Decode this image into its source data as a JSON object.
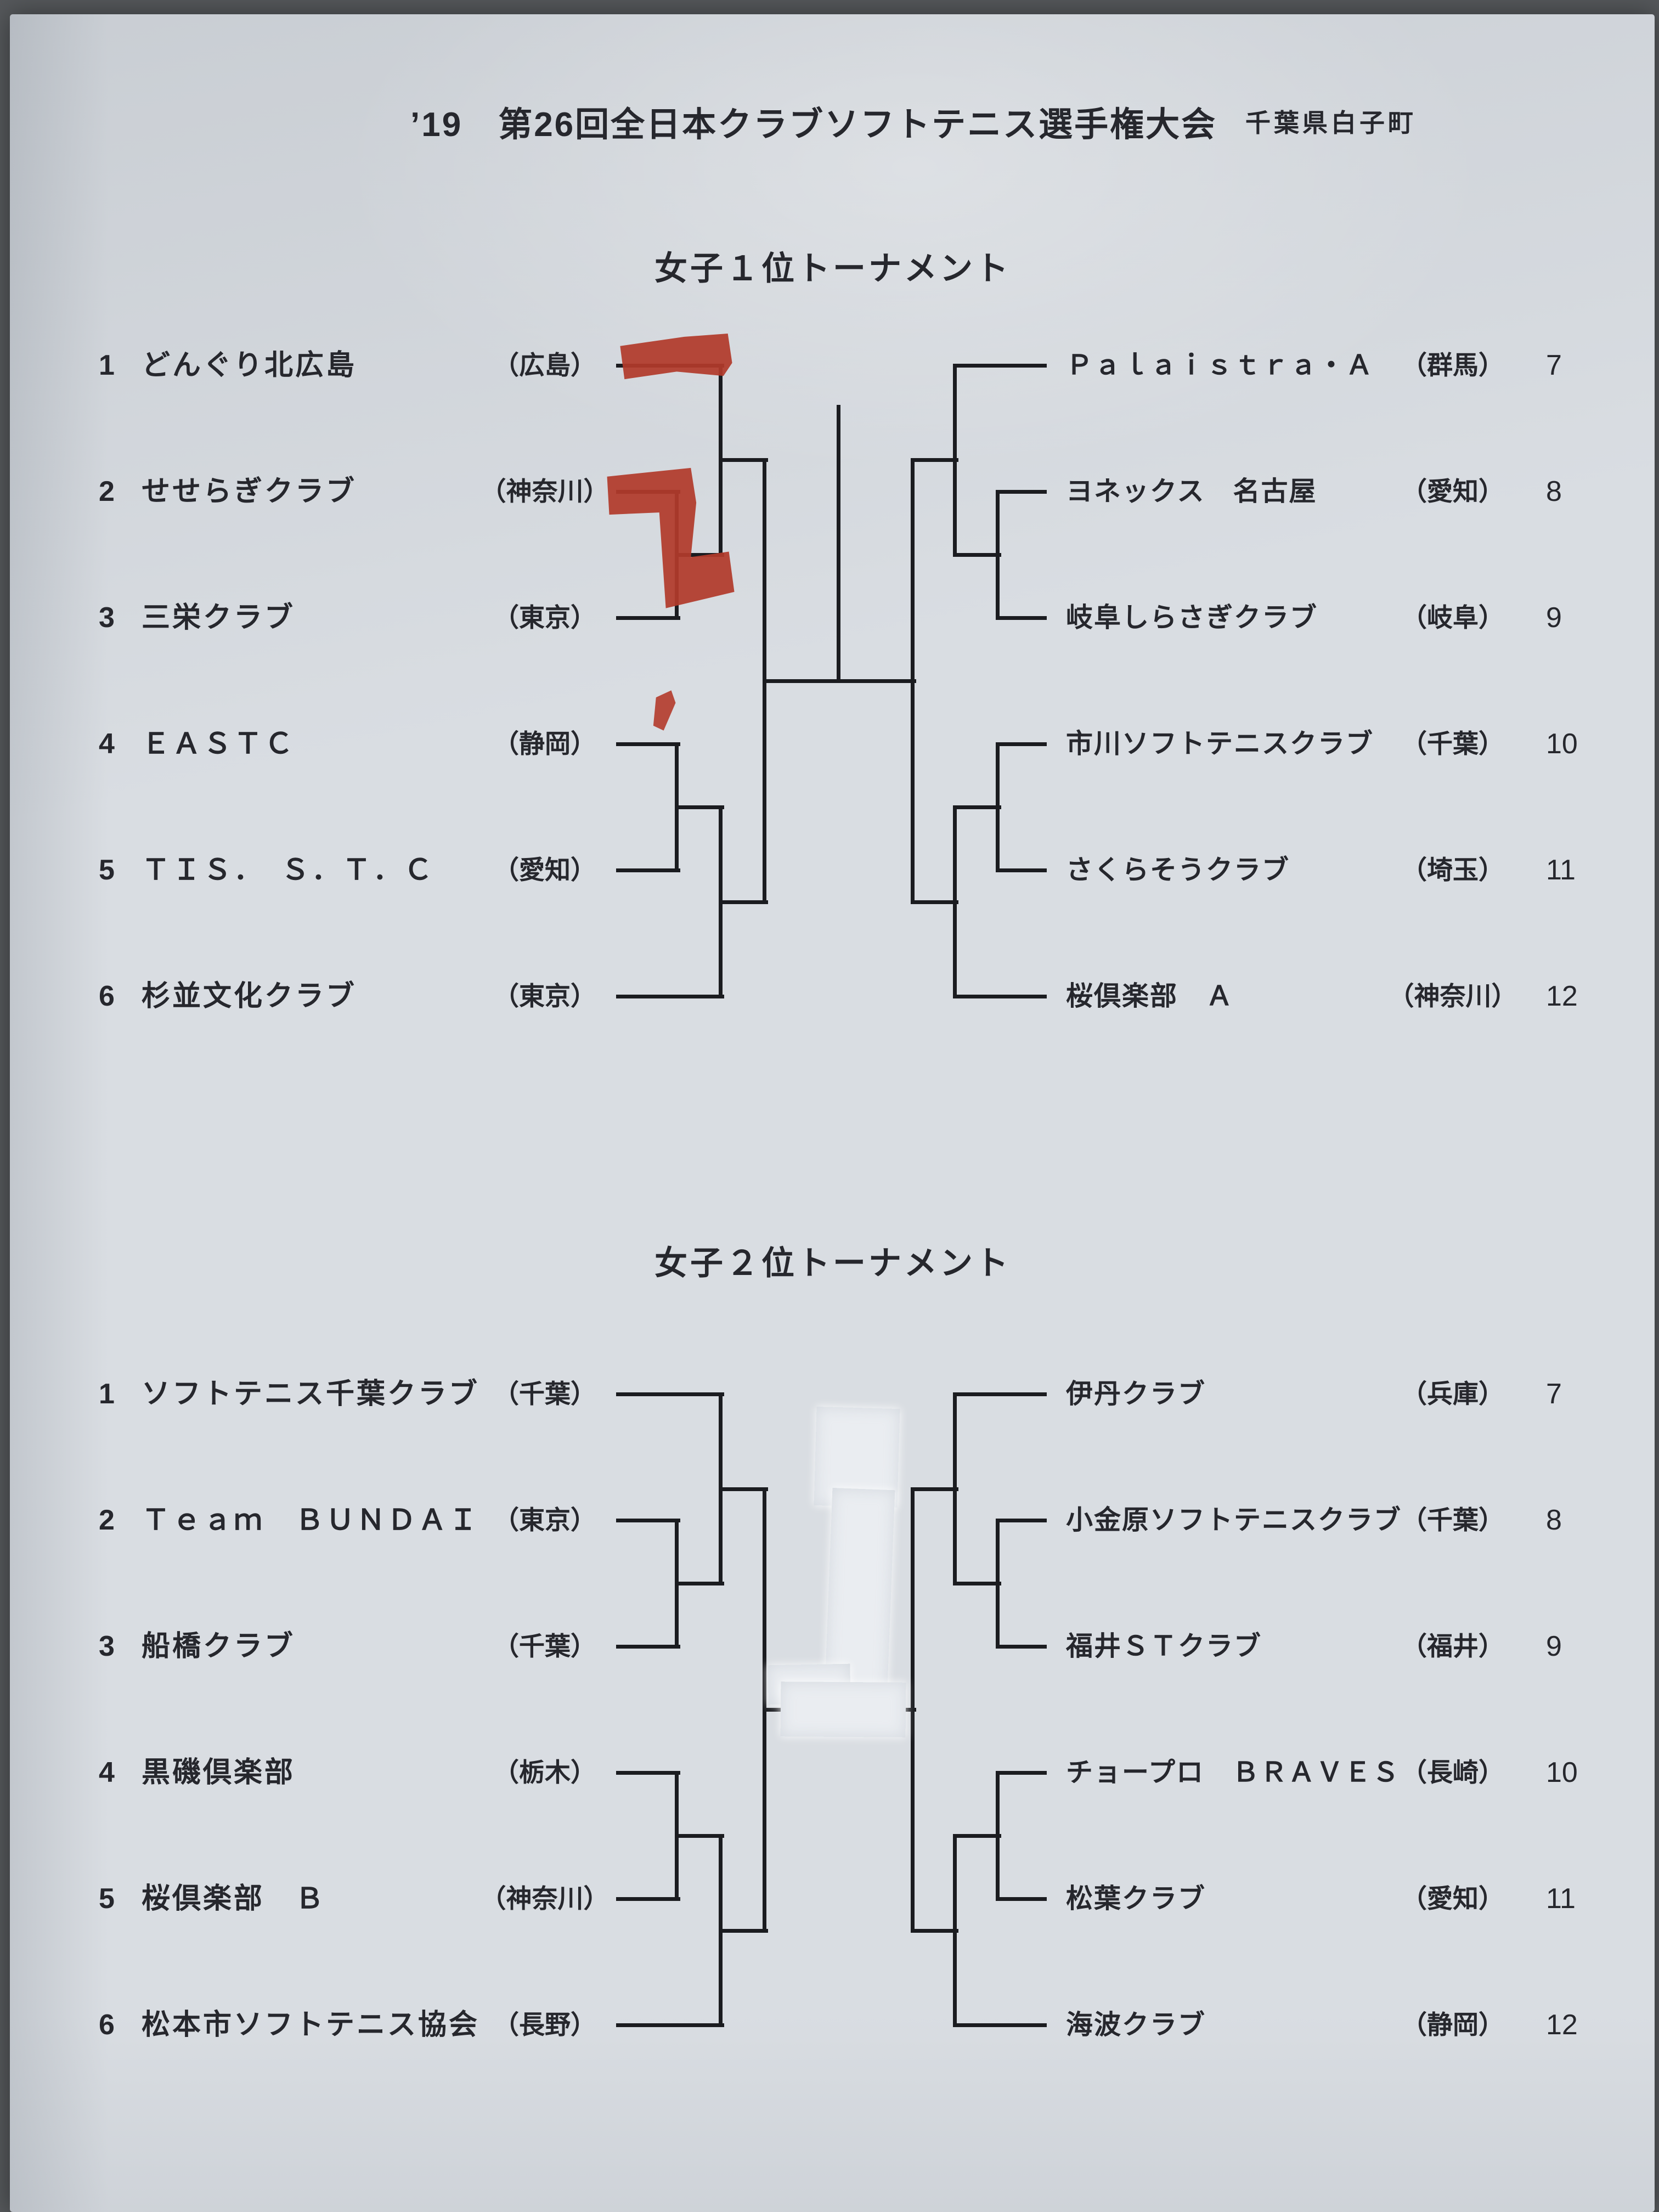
{
  "header": {
    "event_title": "’19　第26回全日本クラブソフトテニス選手権大会",
    "location": "千葉県白子町"
  },
  "colors": {
    "paper": "#d9dde2",
    "ink": "#26272d",
    "bracket_line": "#1b1c20",
    "red_marker": "#b23a2b",
    "correction_tape": "#eaedf1",
    "backdrop": "#55585b"
  },
  "tournaments": [
    {
      "title": "女子１位トーナメント",
      "left": [
        {
          "seed": "1",
          "name": "どんぐり北広島",
          "pref": "（広島）"
        },
        {
          "seed": "2",
          "name": "せせらぎクラブ",
          "pref": "（神奈川）"
        },
        {
          "seed": "3",
          "name": "三栄クラブ",
          "pref": "（東京）"
        },
        {
          "seed": "4",
          "name": "ＥＡＳＴＣ",
          "pref": "（静岡）"
        },
        {
          "seed": "5",
          "name": "ＴＩＳ．　Ｓ．Ｔ．Ｃ",
          "pref": "（愛知）"
        },
        {
          "seed": "6",
          "name": "杉並文化クラブ",
          "pref": "（東京）"
        }
      ],
      "right": [
        {
          "seed": "7",
          "name": "Ｐａｌａｉｓｔｒａ・Ａ",
          "pref": "（群馬）"
        },
        {
          "seed": "8",
          "name": "ヨネックス　名古屋",
          "pref": "（愛知）"
        },
        {
          "seed": "9",
          "name": "岐阜しらさぎクラブ",
          "pref": "（岐阜）"
        },
        {
          "seed": "10",
          "name": "市川ソフトテニスクラブ",
          "pref": "（千葉）"
        },
        {
          "seed": "11",
          "name": "さくらそうクラブ",
          "pref": "（埼玉）"
        },
        {
          "seed": "12",
          "name": "桜倶楽部　Ａ",
          "pref": "（神奈川）"
        }
      ]
    },
    {
      "title": "女子２位トーナメント",
      "left": [
        {
          "seed": "1",
          "name": "ソフトテニス千葉クラブ",
          "pref": "（千葉）"
        },
        {
          "seed": "2",
          "name": "Ｔｅａｍ　ＢＵＮＤＡＩ",
          "pref": "（東京）"
        },
        {
          "seed": "3",
          "name": "船橋クラブ",
          "pref": "（千葉）"
        },
        {
          "seed": "4",
          "name": "黒磯倶楽部",
          "pref": "（栃木）"
        },
        {
          "seed": "5",
          "name": "桜倶楽部　Ｂ",
          "pref": "（神奈川）"
        },
        {
          "seed": "6",
          "name": "松本市ソフトテニス協会",
          "pref": "（長野）"
        }
      ],
      "right": [
        {
          "seed": "7",
          "name": "伊丹クラブ",
          "pref": "（兵庫）"
        },
        {
          "seed": "8",
          "name": "小金原ソフトテニスクラブ",
          "pref": "（千葉）"
        },
        {
          "seed": "9",
          "name": "福井ＳＴクラブ",
          "pref": "（福井）"
        },
        {
          "seed": "10",
          "name": "チョープロ　ＢＲＡＶＥＳ",
          "pref": "（長崎）"
        },
        {
          "seed": "11",
          "name": "松葉クラブ",
          "pref": "（愛知）"
        },
        {
          "seed": "12",
          "name": "海波クラブ",
          "pref": "（静岡）"
        }
      ]
    }
  ],
  "annotations": {
    "red_marker_note": "hand-drawn red marker strokes over seed 1 line and seed 2/3 junction",
    "correction_tape_note": "white correction tape covering the 2nd tournament final/champion lines"
  }
}
